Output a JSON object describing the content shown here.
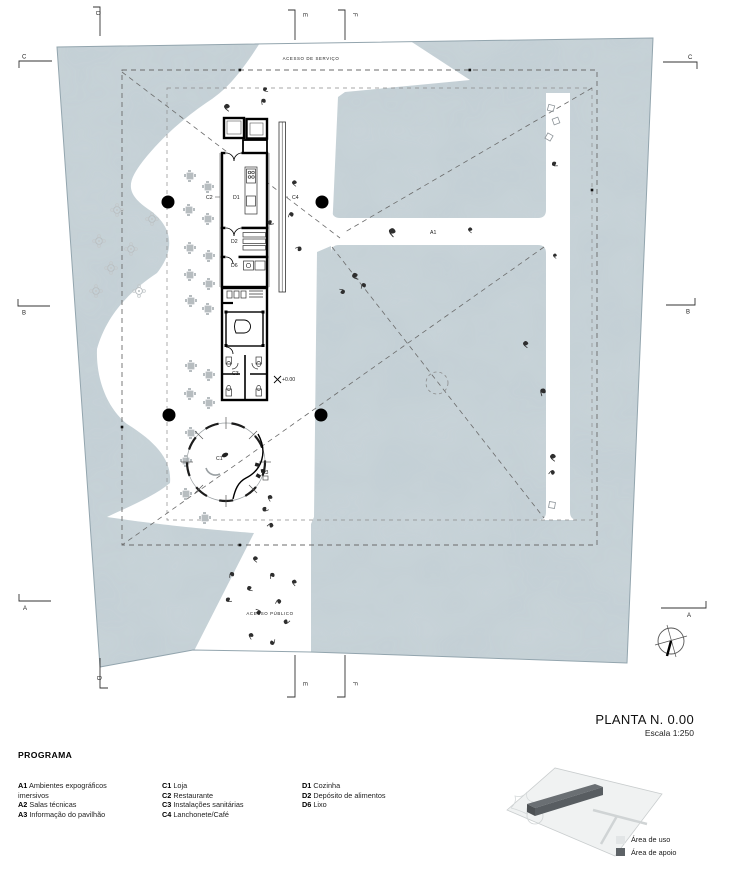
{
  "sheet": {
    "title": "PLANTA N. 0.00",
    "scale": "Escala 1:250"
  },
  "programa": {
    "heading": "PROGRAMA",
    "columns": [
      {
        "items": [
          {
            "code": "A1",
            "label": "Ambientes expográficos imersivos"
          },
          {
            "code": "A2",
            "label": "Salas técnicas"
          },
          {
            "code": "A3",
            "label": "Informação do pavilhão"
          }
        ]
      },
      {
        "items": [
          {
            "code": "C1",
            "label": "Loja"
          },
          {
            "code": "C2",
            "label": "Restaurante"
          },
          {
            "code": "C3",
            "label": "Instalações sanitárias"
          },
          {
            "code": "C4",
            "label": "Lanchonete/Café"
          }
        ]
      },
      {
        "items": [
          {
            "code": "D1",
            "label": "Cozinha"
          },
          {
            "code": "D2",
            "label": "Depósito de alimentos"
          },
          {
            "code": "D6",
            "label": "Lixo"
          }
        ]
      }
    ]
  },
  "area_legend": {
    "items": [
      {
        "label": "Área de uso",
        "color": "#e2e5e6"
      },
      {
        "label": "Área de apoio",
        "color": "#5d6266"
      }
    ]
  },
  "plan": {
    "annotations": {
      "access_service": "ACESSO DE SERVIÇO",
      "access_public": "ACESSO PÚBLICO",
      "level": "+0.00"
    },
    "room_labels": {
      "a1": "A1",
      "a3": "A3",
      "c1": "C1",
      "c2": "C2",
      "c3": "C3",
      "c4": "C4",
      "d1": "D1",
      "d2": "D2",
      "d6": "D6"
    },
    "section_markers": {
      "top": [
        "D",
        "E",
        "F"
      ],
      "bottom": [
        "D",
        "E",
        "F"
      ],
      "left": [
        "C",
        "B",
        "A"
      ],
      "right": [
        "C",
        "B",
        "A"
      ]
    },
    "colors": {
      "water": "#c9d4d9",
      "wall": "#000000",
      "dash": "#6b6b6b",
      "furniture": "#b7bdc0"
    }
  }
}
